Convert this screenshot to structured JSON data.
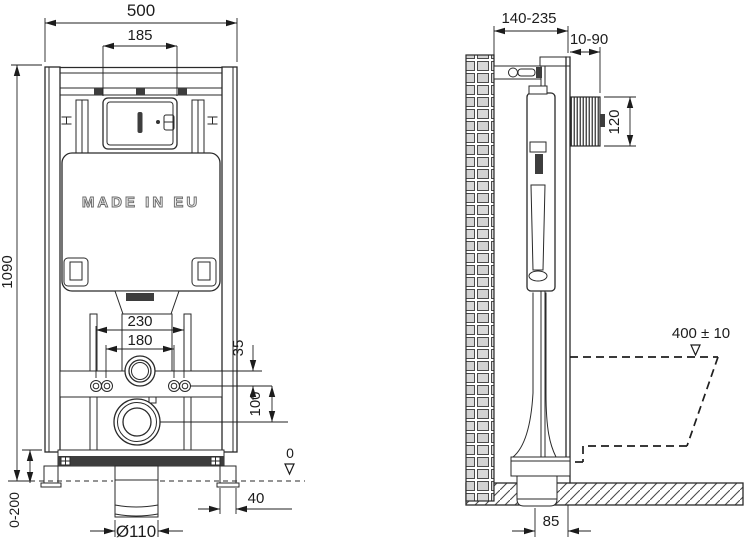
{
  "front_view": {
    "overall_width": "500",
    "plate_opening_width": "185",
    "overall_height": "1090",
    "leg_adjustment_range": "0-200",
    "embossed_text": "MADE IN EU",
    "fixing_bolt_spacing_wide": "230",
    "fixing_bolt_spacing_narrow": "180",
    "flush_pipe_offset": "35",
    "outlet_offset": "100",
    "floor_level": "0",
    "foot_width": "40",
    "outlet_diameter": "Ø110"
  },
  "side_view": {
    "installation_depth_range": "140-235",
    "flush_plate_depth_range": "10-90",
    "flush_plate_height": "120",
    "bowl_rim_height": "400 ± 10",
    "outlet_distance": "85"
  },
  "colors": {
    "line": "#2a2a2a",
    "background": "#ffffff"
  }
}
